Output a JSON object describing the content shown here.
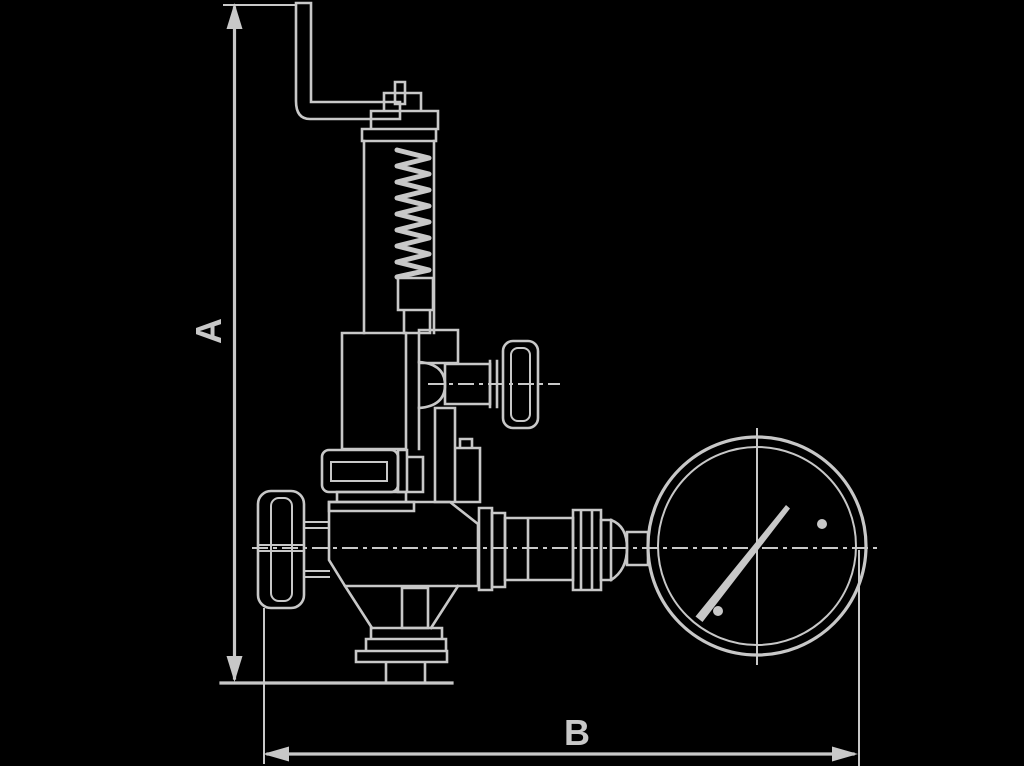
{
  "figure": {
    "kind": "technical-line-drawing",
    "subject": "spring-loaded valve with lever, hand-wheels and pressure gauge",
    "background_color": "#000000",
    "line_color": "#c8c8c8"
  },
  "dimensions": {
    "vertical_label": "A",
    "horizontal_label": "B"
  }
}
